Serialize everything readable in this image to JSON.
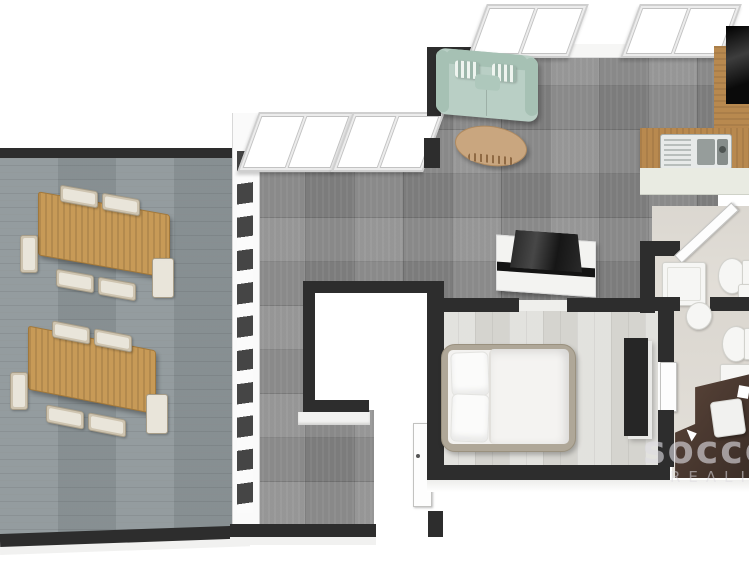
{
  "watermark": {
    "line1": "socce",
    "line2": "REALIT"
  },
  "palette": {
    "white": "#ffffff",
    "wall": "#2d2d2d",
    "terraceFloor": "#8e979a",
    "tileFloor": "#8a8a8a",
    "bedroomFloor": "#d9d8d3",
    "bathFloor": "#e2ded7",
    "wood": "#b8894f",
    "cabinet": "#e9ebe2",
    "sofa": "#b9cfc5",
    "sofaTrim": "#a6c1b4",
    "table": "#c79a57",
    "coffee": "#c9a67f",
    "chair": "#cec4b0",
    "bedFrame": "#afa798",
    "bedding": "#f3f2f0",
    "dark": "#262626",
    "desk": "#4c3a31",
    "fixture": "#f6f6f4",
    "black": "#151515",
    "watermark": "#dedce2"
  },
  "scene": {
    "type": "3d-floor-plan-render",
    "rooms": [
      {
        "name": "terrace",
        "floor": "grey-blue wood planks",
        "furniture": [
          "dining-table-with-6-chairs",
          "dining-table-with-6-chairs"
        ]
      },
      {
        "name": "entrance-hall-sunroom",
        "floor": "grey ceramic tile",
        "features": [
          "floor-to-ceiling-window-wall",
          "two-sliding-windows",
          "entrance-door",
          "white-void-space"
        ]
      },
      {
        "name": "living-room",
        "floor": "grey ceramic tile",
        "furniture": [
          "mint-green-sofa",
          "oval-coffee-table",
          "tv-on-white-lowboard"
        ],
        "features": [
          "two-sliding-windows"
        ]
      },
      {
        "name": "kitchen",
        "furniture": [
          "l-shaped-wooden-counter",
          "stainless-steel-sink",
          "black-cooktop",
          "cabinet-front"
        ]
      },
      {
        "name": "bathroom",
        "furniture": [
          "open-door",
          "shower-tray",
          "toilet"
        ]
      },
      {
        "name": "wc",
        "furniture": [
          "washbasin",
          "toilet",
          "white-counter"
        ]
      },
      {
        "name": "bedroom",
        "floor": "whitewashed wood",
        "furniture": [
          "double-bed-white-bedding",
          "dark-wardrobe-panel",
          "door"
        ]
      },
      {
        "name": "office",
        "furniture": [
          "dark-brown-desk",
          "white-chair",
          "paper-sheet"
        ]
      }
    ]
  }
}
